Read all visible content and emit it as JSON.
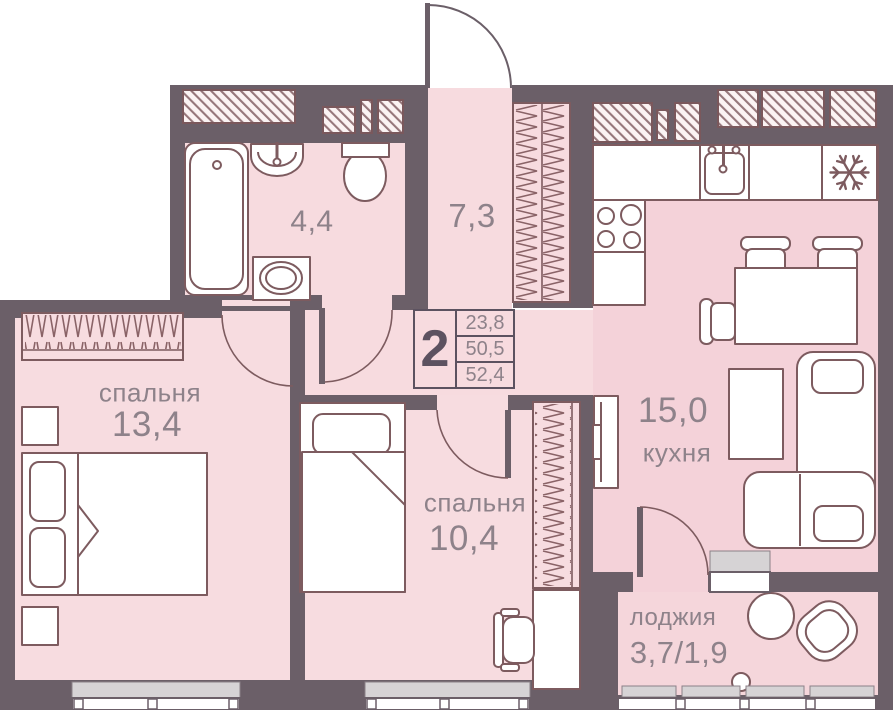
{
  "plan_title": "2-room apartment floor plan",
  "info_box": {
    "rooms_count": "2",
    "values": [
      "23,8",
      "50,5",
      "52,4"
    ]
  },
  "rooms": {
    "bathroom": {
      "area": "4,4"
    },
    "hallway": {
      "area": "7,3"
    },
    "bedroom1": {
      "label": "спальня",
      "area": "13,4"
    },
    "bedroom2": {
      "label": "спальня",
      "area": "10,4"
    },
    "kitchen": {
      "label": "кухня",
      "area": "15,0"
    },
    "loggia": {
      "label": "лоджия",
      "area": "3,7/1,9"
    }
  },
  "icons": {
    "fridge": "snowflake-icon"
  },
  "colors": {
    "wall": "#6b5f68",
    "floor": "#f7dbdf",
    "floor_kitchen": "#f4d2d9",
    "furniture_line": "#7d5b5f",
    "hatch_line": "#96777b",
    "sill": "#d6d3d5",
    "text": "#8e828a",
    "accent_dark": "#5c5260"
  }
}
